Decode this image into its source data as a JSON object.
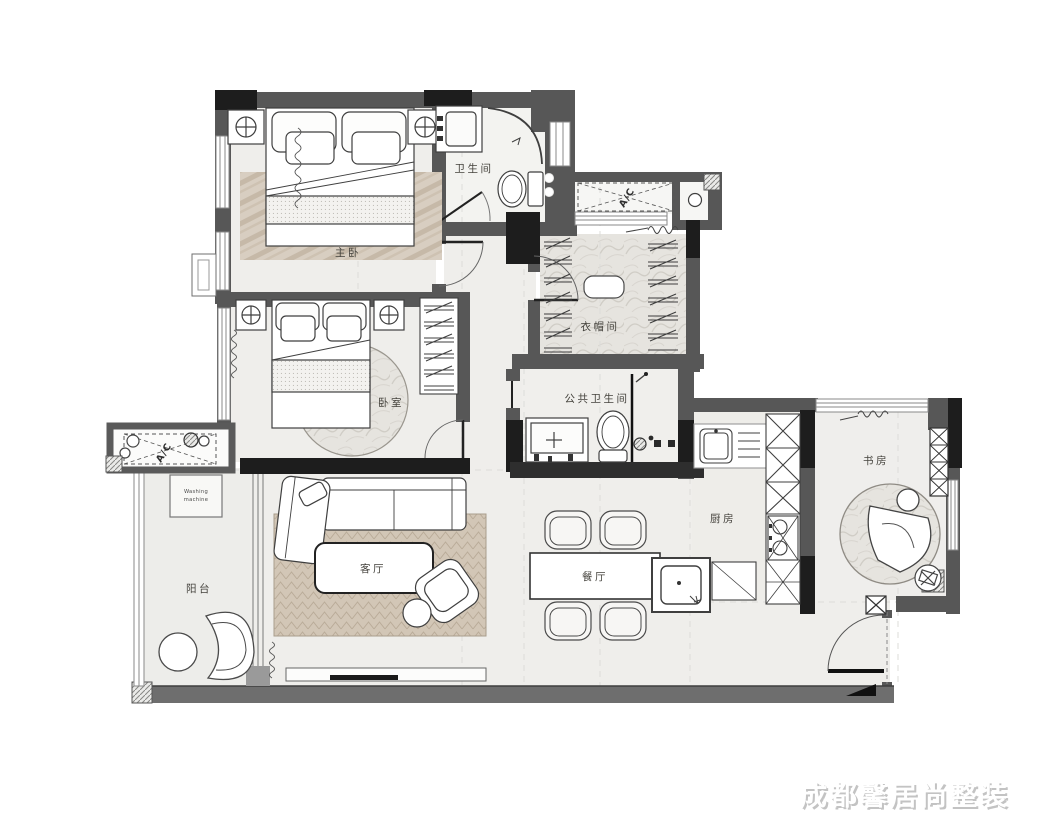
{
  "watermark": "成都馨居尚整装",
  "rooms": {
    "master_bedroom": {
      "label": "主卧"
    },
    "bathroom": {
      "label": "卫生间"
    },
    "cloakroom": {
      "label": "衣帽间"
    },
    "public_bathroom": {
      "label": "公共卫生间"
    },
    "bedroom": {
      "label": "卧室"
    },
    "living_room": {
      "label": "客厅"
    },
    "balcony": {
      "label": "阳台"
    },
    "dining_room": {
      "label": "餐厅"
    },
    "kitchen": {
      "label": "厨房"
    },
    "study": {
      "label": "书房"
    }
  },
  "annotations": {
    "ac_unit_top": {
      "label": "A/C"
    },
    "ac_unit_left": {
      "label": "A/C"
    },
    "washing_machine": {
      "line1": "Washing",
      "line2": "machine"
    }
  },
  "colors": {
    "wall_gray": "#575757",
    "wall_black": "#1d1d1d",
    "floor_light": "#efeeeb",
    "rug_tan": "#d2c6b6",
    "label_text": "#45433d",
    "watermark_text": "#ffffff"
  }
}
